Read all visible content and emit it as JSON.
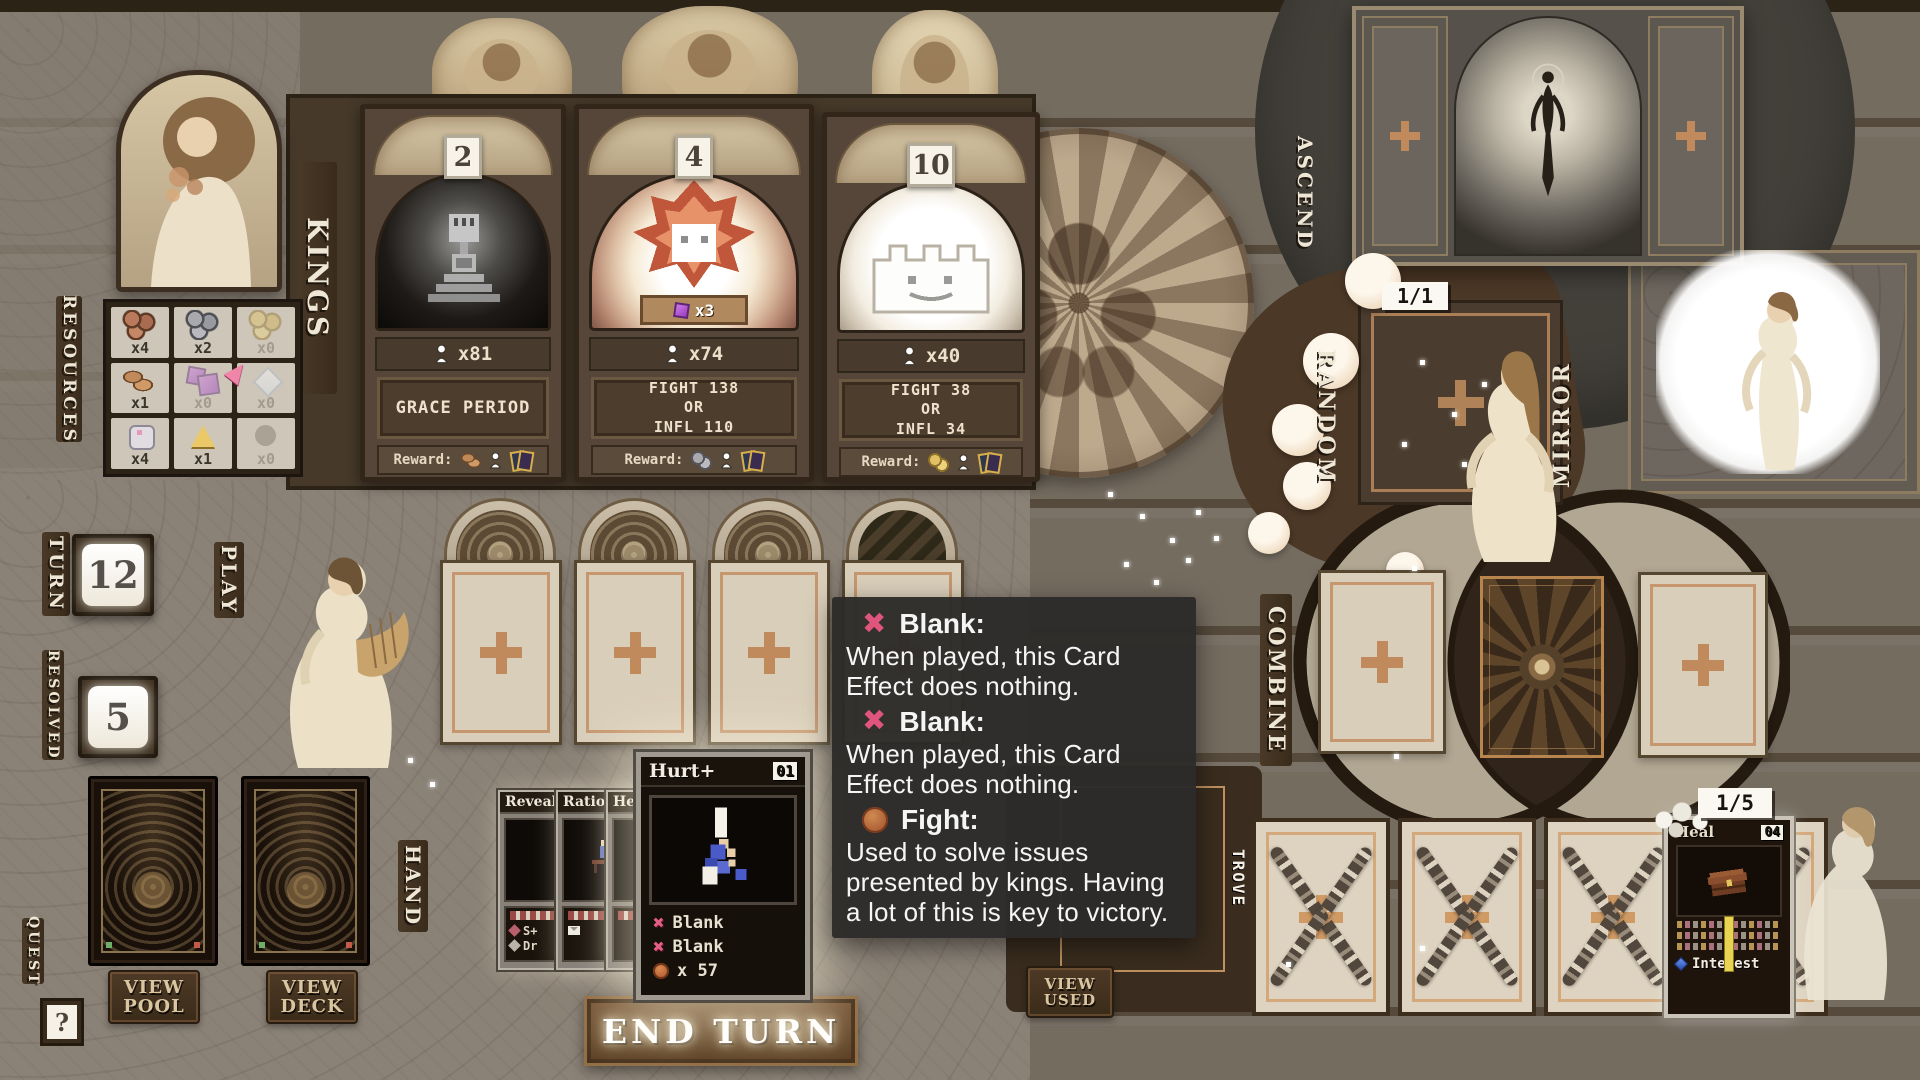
{
  "labels": {
    "kings": "KINGS",
    "resources": "RESOURCES",
    "turn": "TURN",
    "resolved": "RESOLVED",
    "play": "PLAY",
    "hand": "HAND",
    "quest": "QUEST",
    "ascend": "ASCEND",
    "random": "RANDOM",
    "mirror": "MIRROR",
    "combine": "COMBINE",
    "trove": "TROVE"
  },
  "counters": {
    "turn": "12",
    "resolved": "5",
    "ascend_slots": "1/1",
    "trove_slots": "1/5"
  },
  "kings": [
    {
      "badge": "2",
      "population": "x81",
      "objective_lines": [
        "GRACE PERIOD"
      ],
      "reward_label": "Reward:"
    },
    {
      "badge": "4",
      "population": "x74",
      "demand": "x3",
      "objective_lines": [
        "FIGHT 138",
        "OR",
        "INFL 110"
      ],
      "reward_label": "Reward:"
    },
    {
      "badge": "10",
      "population": "x40",
      "objective_lines": [
        "FIGHT 38",
        "OR",
        "INFL 34"
      ],
      "reward_label": "Reward:"
    }
  ],
  "resources": {
    "cells": [
      {
        "icon": "copper-coins",
        "count": "x4"
      },
      {
        "icon": "silver-coins",
        "count": "x2"
      },
      {
        "icon": "gold-coins",
        "count": "x0"
      },
      {
        "icon": "bread",
        "count": "x1"
      },
      {
        "icon": "purple-cubes",
        "count": "x0"
      },
      {
        "icon": "white-diamond",
        "count": "x0"
      },
      {
        "icon": "stone",
        "count": "x4"
      },
      {
        "icon": "gold-triangle",
        "count": "x1"
      },
      {
        "icon": "gray-orb",
        "count": "x0"
      }
    ]
  },
  "buttons": {
    "view_pool_line1": "VIEW",
    "view_pool_line2": "POOL",
    "view_deck_line1": "VIEW",
    "view_deck_line2": "DECK",
    "view_used_line1": "VIEW",
    "view_used_line2": "USED",
    "end_turn": "END TURN",
    "quest_help": "?"
  },
  "hand": {
    "stacked_cards": [
      {
        "title": "Reveal",
        "lines": [
          "S+",
          "Dr"
        ]
      },
      {
        "title": "Ration",
        "lines": []
      },
      {
        "title": "He",
        "lines": []
      }
    ],
    "active_card": {
      "title": "Hurt+",
      "count": "01",
      "effects": [
        {
          "icon": "blank-x",
          "label": "Blank"
        },
        {
          "icon": "blank-x",
          "label": "Blank"
        },
        {
          "icon": "fight",
          "label": "x 57"
        }
      ]
    }
  },
  "tooltip": {
    "entries": [
      {
        "icon": "blank-x",
        "term": "Blank:",
        "body": "When played, this Card Effect does nothing."
      },
      {
        "icon": "blank-x",
        "term": "Blank:",
        "body": "When played, this Card Effect does nothing."
      },
      {
        "icon": "fight",
        "term": "Fight:",
        "body": "Used to solve issues presented by kings. Having a lot of this is key to victory."
      }
    ]
  },
  "trove_card": {
    "title": "Heal",
    "count": "04",
    "footer": "Interest"
  }
}
